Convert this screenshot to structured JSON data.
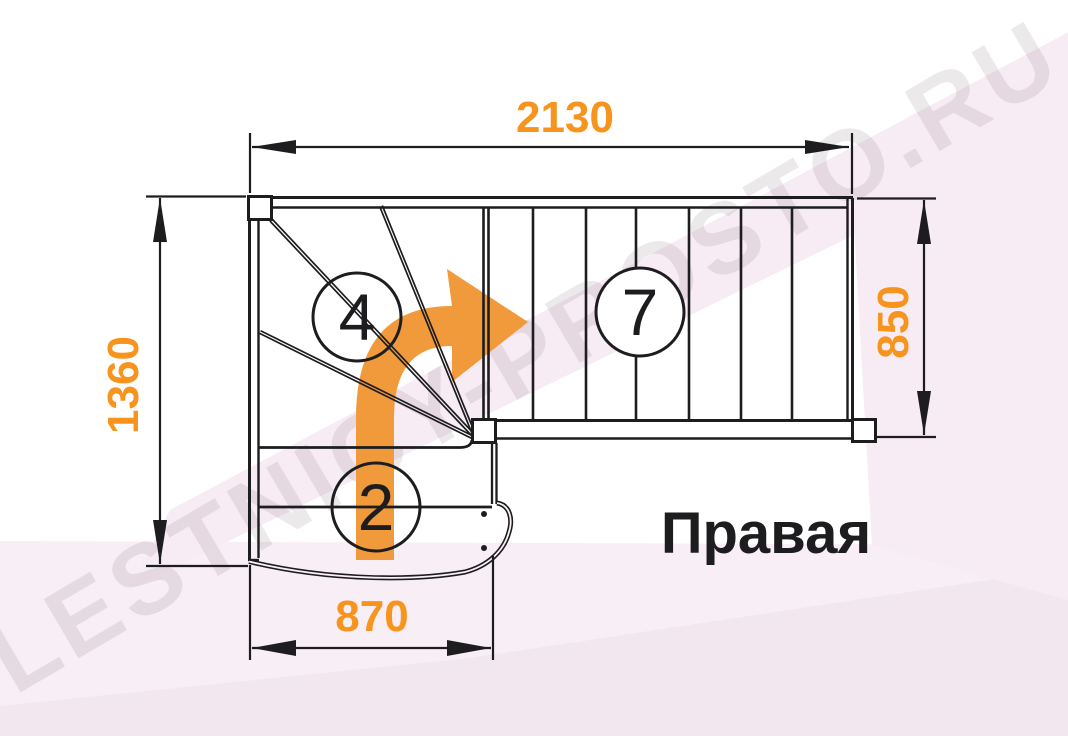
{
  "drawing": {
    "title_label": "Правая",
    "watermark": "LESTNICY-PROSTO.RU",
    "dimensions": {
      "top": "2130",
      "left": "1360",
      "right": "850",
      "bottom": "870"
    },
    "step_counts": {
      "winder_steps": "4",
      "upper_flight_steps": "7",
      "lower_flight_steps": "2"
    },
    "colors": {
      "dimension_text": "#F7941D",
      "direction_arrow": "#F09A3C",
      "line": "#1D1D1F",
      "background_pink": "#F7EBF4",
      "watermark_gray": "#8B7484"
    }
  }
}
